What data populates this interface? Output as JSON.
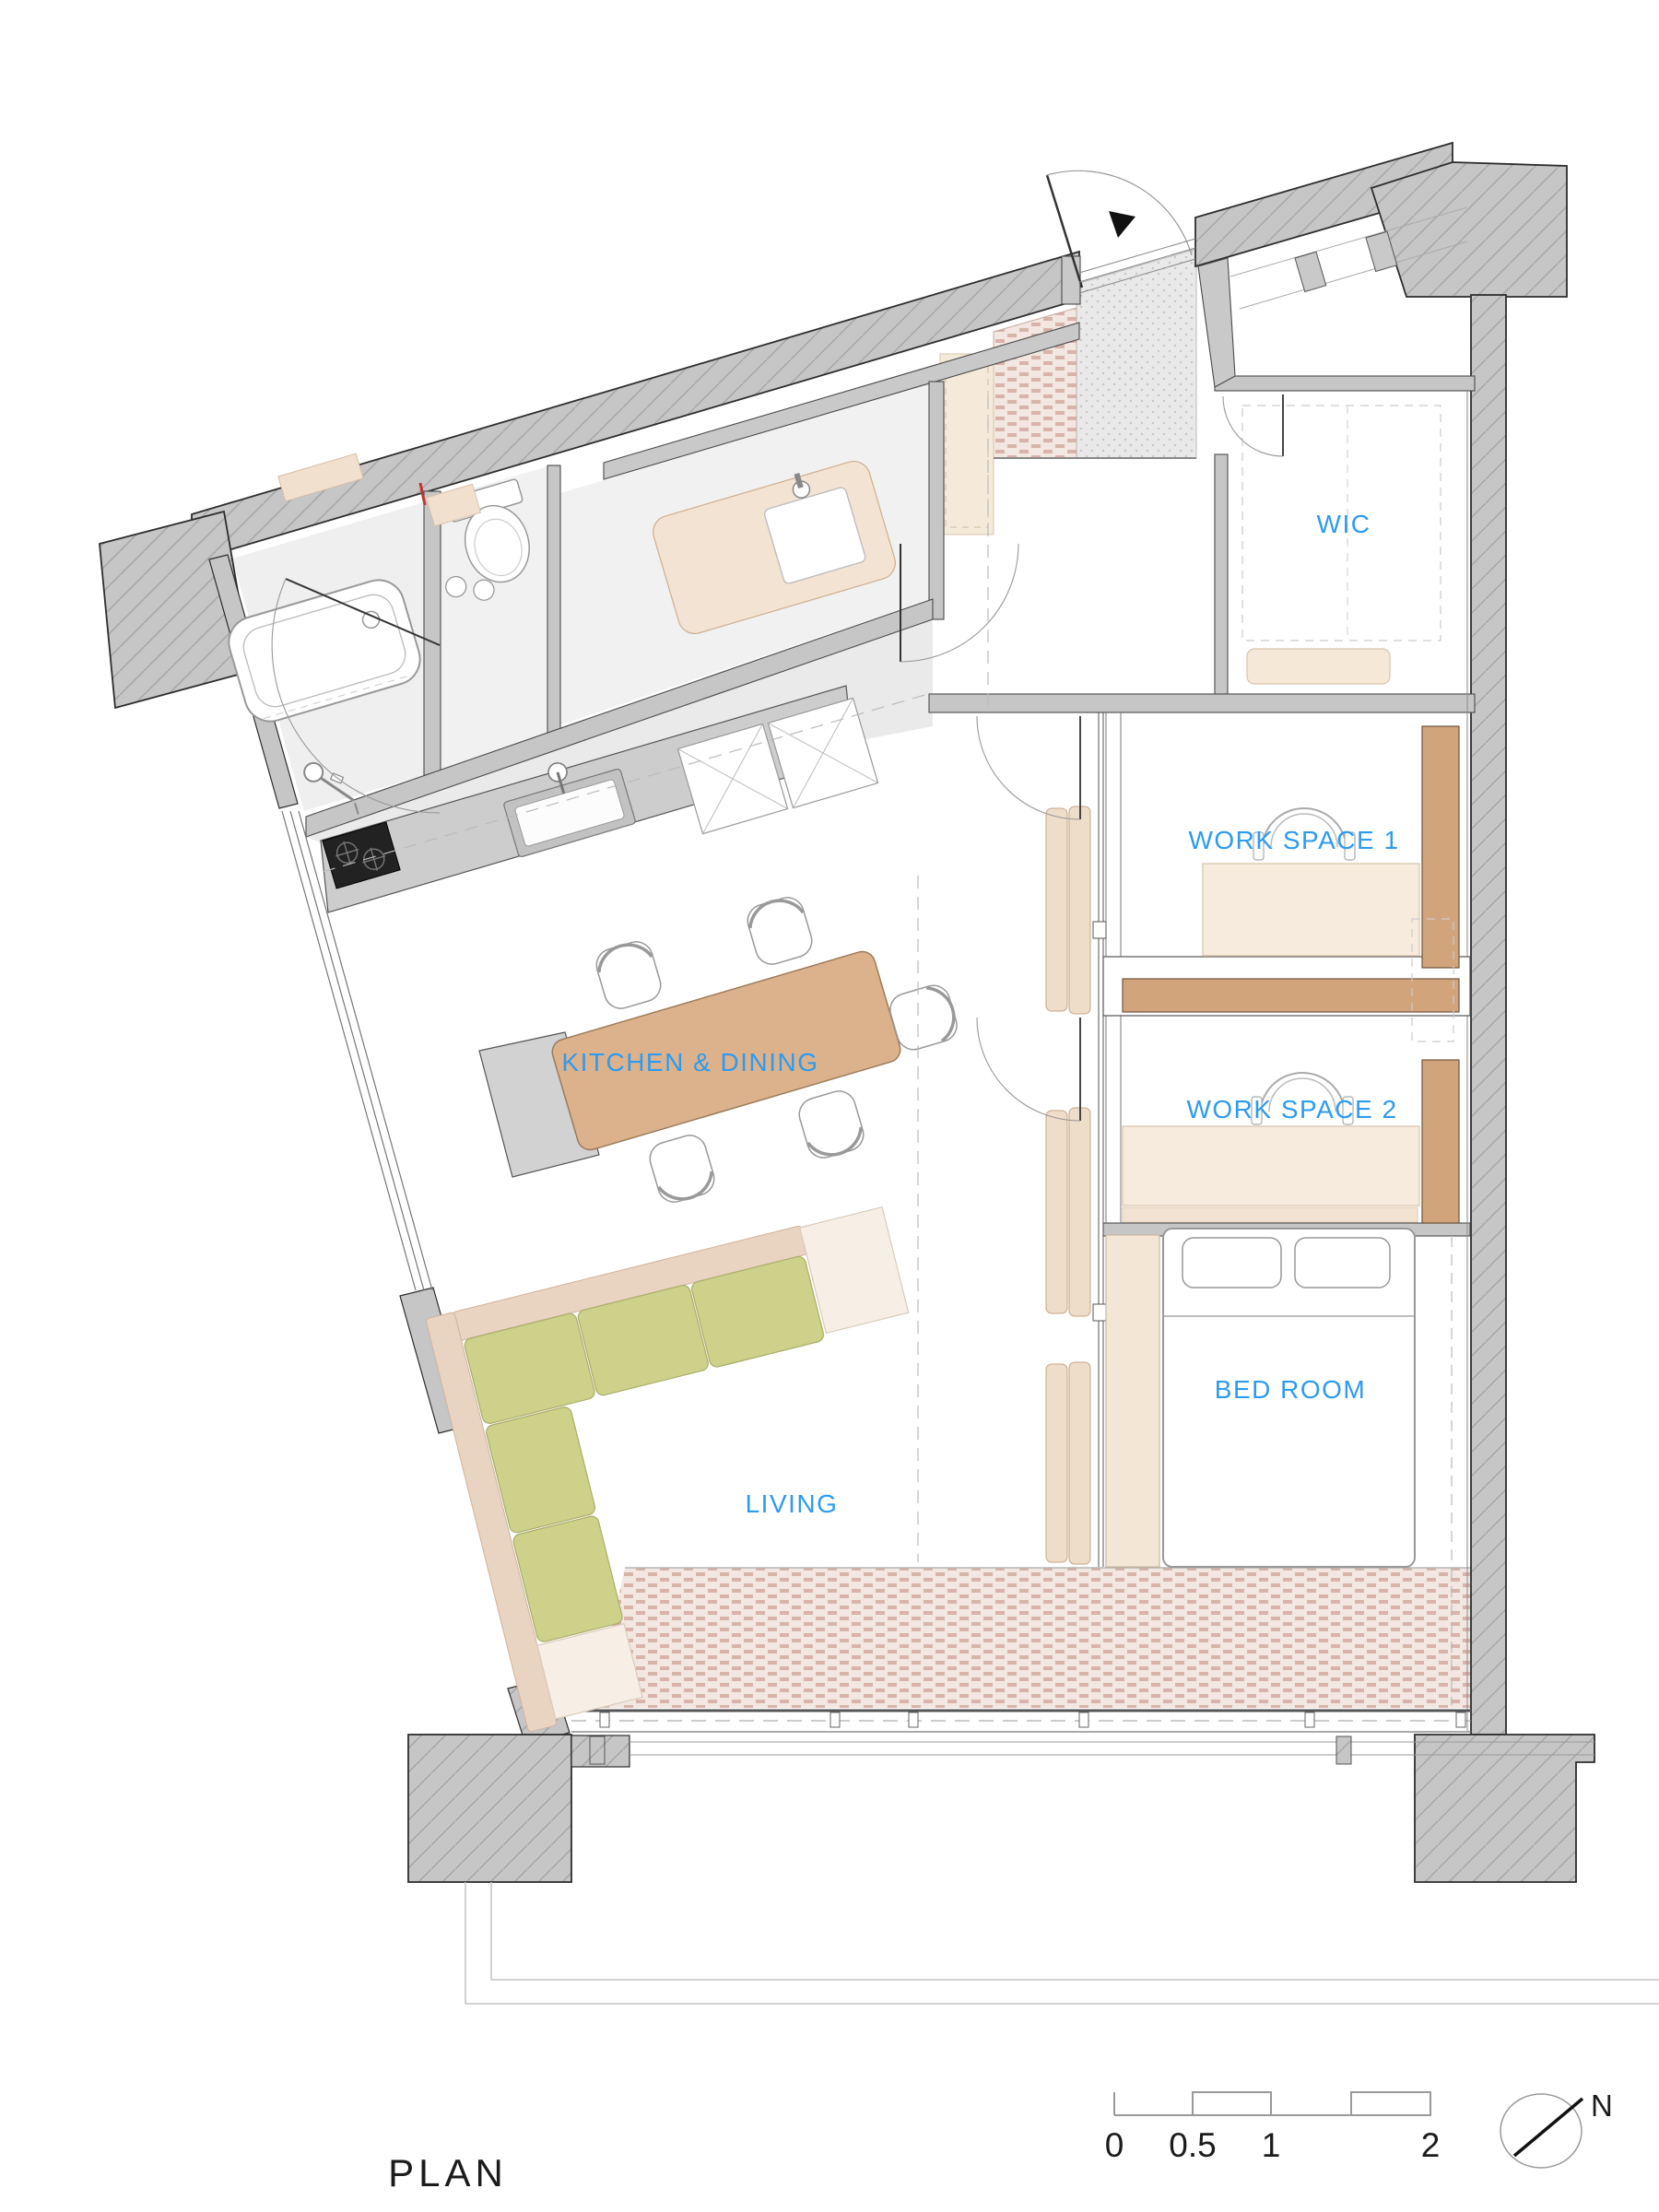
{
  "drawing": {
    "title": "PLAN",
    "rooms": [
      {
        "id": "wic",
        "label": "WIC"
      },
      {
        "id": "work-space-1",
        "label": "WORK SPACE 1"
      },
      {
        "id": "work-space-2",
        "label": "WORK SPACE 2"
      },
      {
        "id": "bed-room",
        "label": "BED ROOM"
      },
      {
        "id": "kitchen-dining",
        "label": "KITCHEN & DINING"
      },
      {
        "id": "living",
        "label": "LIVING"
      }
    ],
    "scale_bar": {
      "ticks": [
        "0",
        "0.5",
        "1",
        "2"
      ]
    },
    "north": {
      "label": "N"
    },
    "colors": {
      "label_blue": "#2D9BF0",
      "wall_gray": "#c6c6c6",
      "wood_brown": "#d2a47c",
      "desk_beige": "#f7ebdd",
      "table_brown": "#dcb28d",
      "sofa_green": "#cdd189",
      "sofa_back_beige": "#e9d3c1",
      "balcony_pink": "#d8b3a9",
      "bed_white": "#ffffff",
      "stove_black": "#222222"
    }
  }
}
